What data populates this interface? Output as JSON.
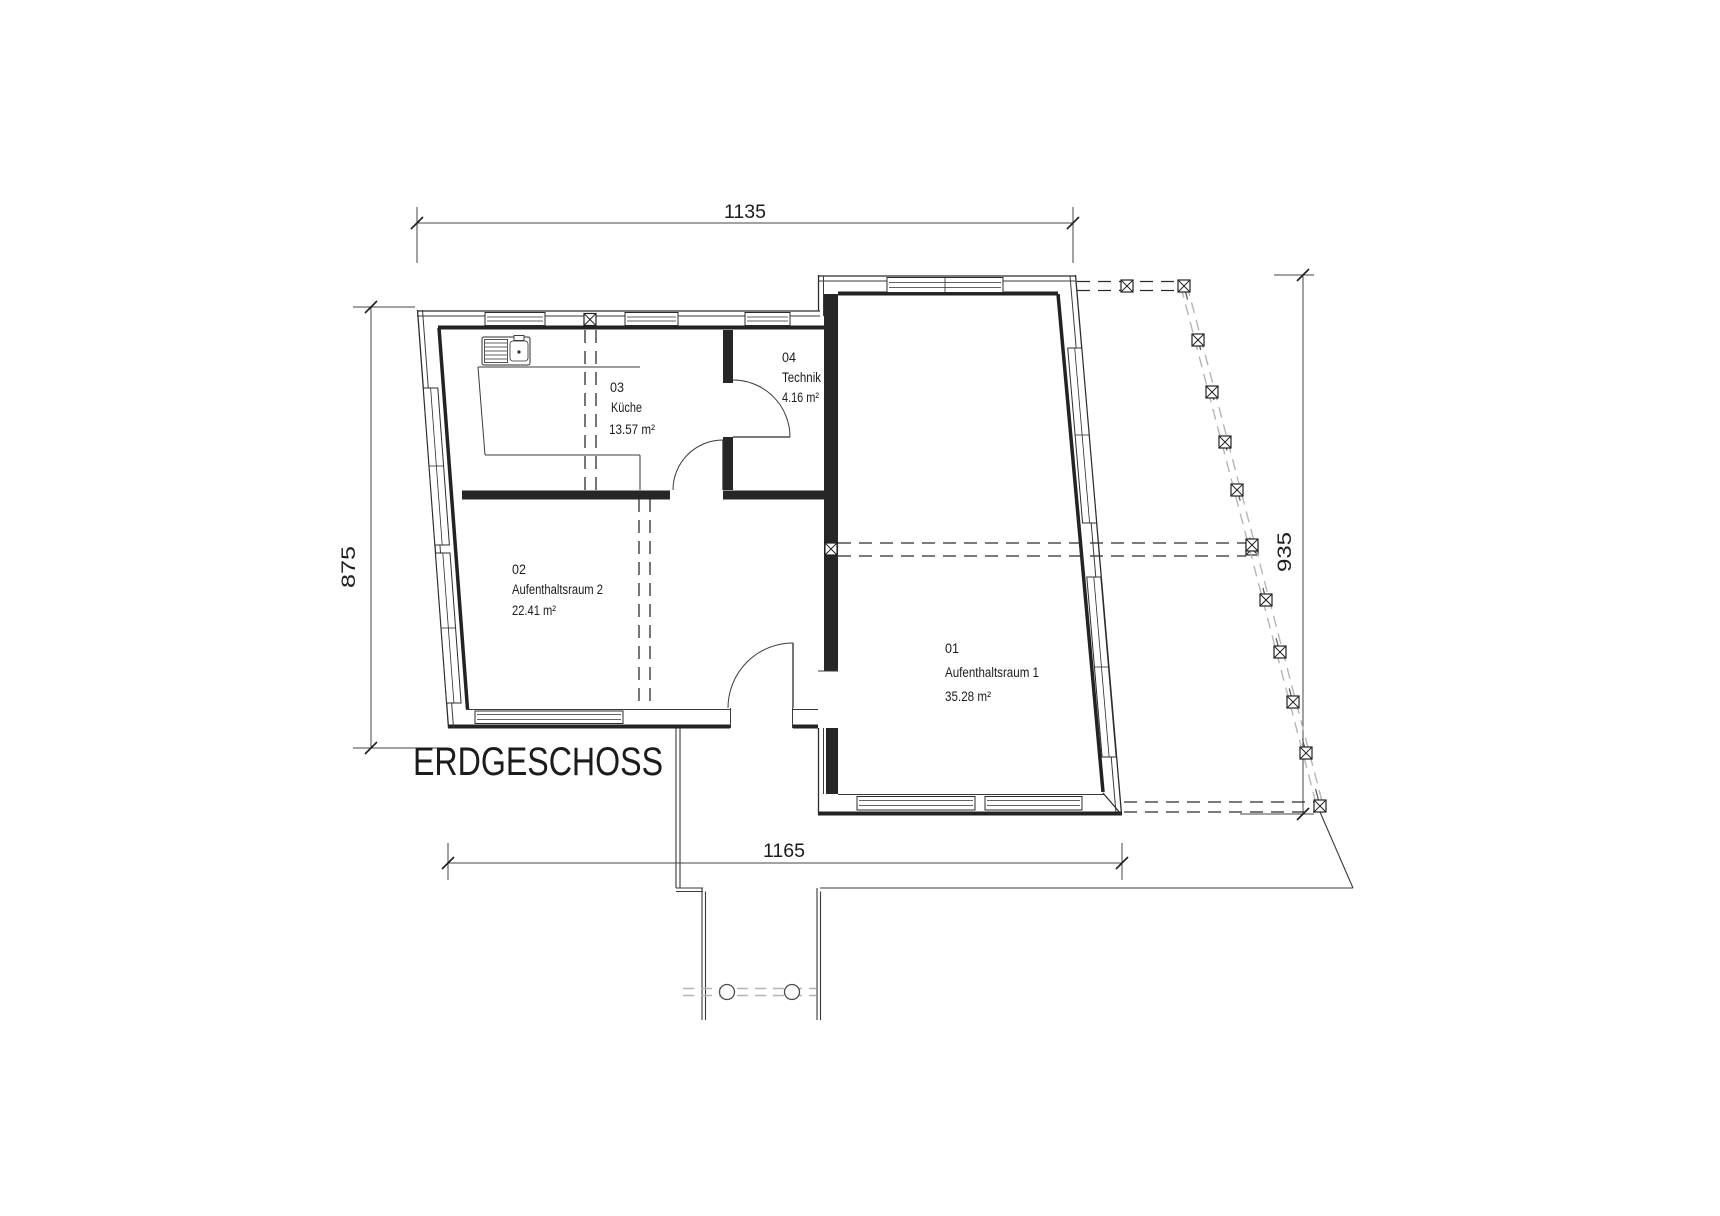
{
  "drawing": {
    "title": "ERDGESCHOSS",
    "dimensions": {
      "top": "1135",
      "left": "875",
      "right": "935",
      "bottom": "1165"
    },
    "rooms": [
      {
        "number": "01",
        "name": "Aufenthaltsraum 1",
        "area": "35.28 m²"
      },
      {
        "number": "02",
        "name": "Aufenthaltsraum 2",
        "area": "22.41 m²"
      },
      {
        "number": "03",
        "name": "Küche",
        "area": "13.57 m²"
      },
      {
        "number": "04",
        "name": "Technik",
        "area": "4.16 m²"
      }
    ],
    "colors": {
      "line": "#2c2c2c",
      "light_line": "#b5b5b5",
      "background": "#ffffff"
    }
  }
}
